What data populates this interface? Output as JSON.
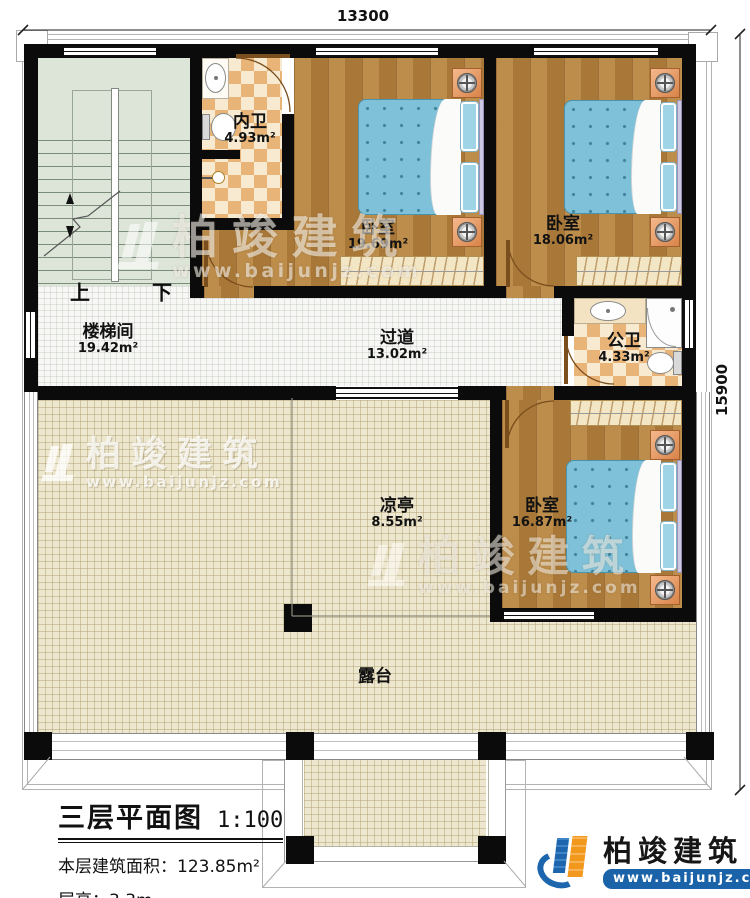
{
  "dims": {
    "width": "13300",
    "height": "15900"
  },
  "rooms": [
    {
      "id": "stairwell",
      "name": "楼梯间",
      "area": "19.42m²"
    },
    {
      "id": "inner-bath",
      "name": "内卫",
      "area": "4.93m²"
    },
    {
      "id": "bedroom1",
      "name": "卧室",
      "area": "19.69m²"
    },
    {
      "id": "bedroom2",
      "name": "卧室",
      "area": "18.06m²"
    },
    {
      "id": "corridor",
      "name": "过道",
      "area": "13.02m²"
    },
    {
      "id": "public-bath",
      "name": "公卫",
      "area": "4.33m²"
    },
    {
      "id": "pavilion",
      "name": "凉亭",
      "area": "8.55m²"
    },
    {
      "id": "bedroom3",
      "name": "卧室",
      "area": "16.87m²"
    },
    {
      "id": "terrace",
      "name": "露台",
      "area": ""
    }
  ],
  "stairs": {
    "up": "上",
    "down": "下"
  },
  "title_block": {
    "title": "三层平面图",
    "scale": "1:100",
    "area_label": "本层建筑面积：",
    "area_value": "123.85m²",
    "floor_height_label": "层高：",
    "floor_height_value": "3.3m"
  },
  "branding": {
    "company": "柏竣建筑",
    "website": "www.baijunjz.com"
  },
  "colors": {
    "wall": "#0b0b0b",
    "wood_floor": "#b5823e",
    "tile_accent": "#e9b478",
    "bed_blue": "#7fc1d8",
    "terrace_beige": "#eee7cf",
    "stair_sage": "#dde5d9",
    "brand_blue": "#1d66ad",
    "brand_orange": "#f2981d"
  }
}
